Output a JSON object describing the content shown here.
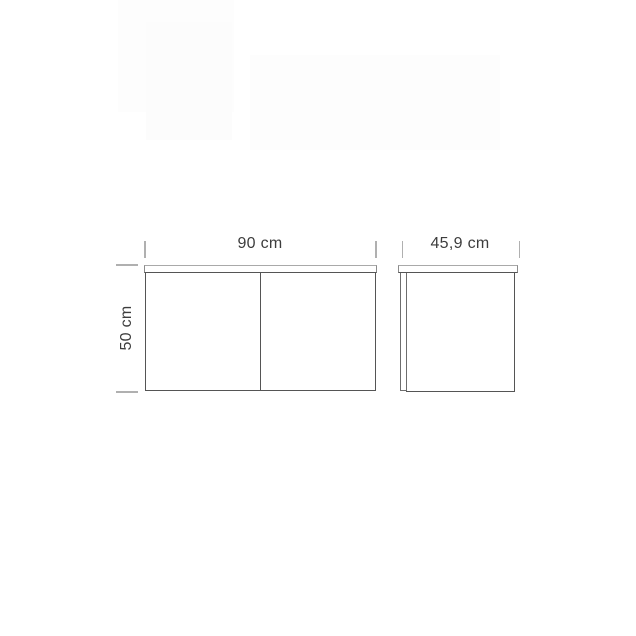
{
  "diagram": {
    "kind": "furniture-dimension-drawing",
    "views": [
      {
        "id": "front",
        "description": "front elevation of two-door cabinet"
      },
      {
        "id": "side",
        "description": "side profile of cabinet with door edge"
      }
    ],
    "dimensions": [
      {
        "view": "front",
        "axis": "width",
        "label": "90 cm",
        "value": 90,
        "unit": "cm"
      },
      {
        "view": "front",
        "axis": "height",
        "label": "50 cm",
        "value": 50,
        "unit": "cm"
      },
      {
        "view": "side",
        "axis": "depth",
        "label": "45,9 cm",
        "value": 45.9,
        "unit": "cm"
      }
    ],
    "colors": {
      "outline": "#555555",
      "panel_top_edge": "#a9a9a9",
      "dimension_marks": "#b0b0b0",
      "label_text": "#3d3d3d",
      "background": "#ffffff"
    }
  }
}
